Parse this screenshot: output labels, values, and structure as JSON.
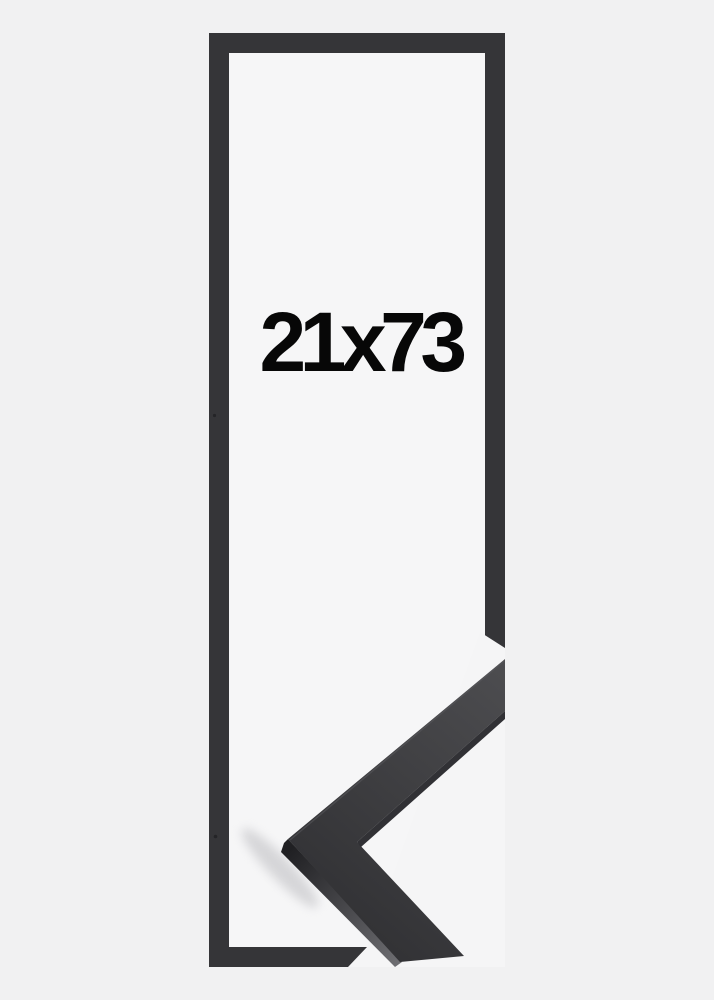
{
  "product_image": {
    "size_label": "21x73",
    "description_label": "frame-size-preview"
  },
  "colors": {
    "background": "#f1f1f2",
    "interior": "#f6f6f7",
    "photo_background": "#f5f5f6",
    "frame_outline": "#353538",
    "text": "#070707",
    "moulding_light": "#4d4d50",
    "moulding_dark": "#313134",
    "moulding_edge": "#26262a",
    "face_dark": "#202023",
    "face_light": "#6f6f73",
    "highlight": "#5a5a5e",
    "shadow": "#bbbbbf",
    "speck": "#242427"
  }
}
